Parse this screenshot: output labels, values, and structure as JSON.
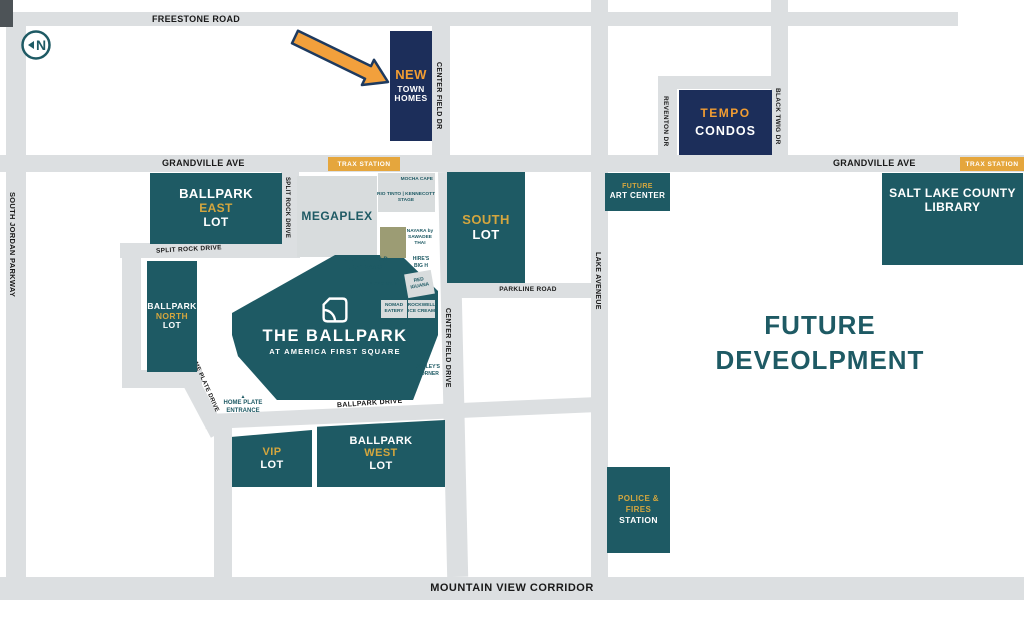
{
  "colors": {
    "teal": "#1e5a64",
    "navy": "#1c2e5a",
    "gold": "#d4a63e",
    "orange": "#f29d32",
    "badge_orange": "#e5a63d",
    "road_gray": "#dcdfe1",
    "building_gray": "#d8dcdd",
    "khaki": "#9c9c74"
  },
  "north_indicator": {
    "letter": "N"
  },
  "roads": {
    "freestone": "FREESTONE ROAD",
    "grandville_west": "GRANDVILLE AVE",
    "grandville_east": "GRANDVILLE AVE",
    "south_jordan": "SOUTH JORDAN PARKWAY",
    "center_field_dr_top": "CENTER FIELD DR",
    "center_field_drive": "CENTER FIELD DRIVE",
    "split_rock_vertical": "SPLIT ROCK DRIVE",
    "split_rock_horizontal": "SPLIT ROCK DRIVE",
    "home_plate_drive": "HOME PLATE DRIVE",
    "ballpark_drive": "BALLPARK DRIVE",
    "parkline": "PARKLINE ROAD",
    "lake_avenue": "LAKE AVENEUE",
    "reventon": "REVENTON DR",
    "black_twig": "BLACK TWIG DR",
    "mountain_view": "MOUNTAIN VIEW CORRIDOR"
  },
  "badges": {
    "trax_west": "TRAX  STATION",
    "trax_east": "TRAX  STATION"
  },
  "buildings": {
    "new_town_homes": {
      "line1": "NEW",
      "line2": "TOWN",
      "line3": "HOMES"
    },
    "tempo_condos": {
      "line1": "TEMPO",
      "line2": "CONDOS"
    },
    "megaplex": {
      "label": "MEGAPLEX"
    },
    "ballpark_east_lot": {
      "line1": "BALLPARK",
      "line2": "EAST",
      "line3": "LOT"
    },
    "ballpark_north_lot": {
      "line1": "BALLPARK",
      "line2": "NORTH",
      "line3": "LOT"
    },
    "south_lot": {
      "line1": "SOUTH",
      "line2": "LOT"
    },
    "vip_lot": {
      "line1": "VIP",
      "line2": "LOT"
    },
    "ballpark_west_lot": {
      "line1": "BALLPARK",
      "line2": "WEST",
      "line3": "LOT"
    },
    "the_ballpark": {
      "title": "THE BALLPARK",
      "subtitle": "AT AMERICA FIRST SQUARE"
    },
    "future_art_center": {
      "line1": "FUTURE",
      "line2": "ART CENTER"
    },
    "library": {
      "line1": "SALT LAKE COUNTY",
      "line2": "LIBRARY"
    },
    "police_fire_station": {
      "line1": "POLICE &",
      "line2": "FIRES",
      "line3": "STATION"
    },
    "future_development": {
      "line1": "FUTURE",
      "line2": "DEVEOLPMENT"
    }
  },
  "pois": {
    "mocha_cafe": "MOCHA CAFE",
    "rio_tinto_stage": {
      "line1": "RIO TINTO | KENNECOTT",
      "line2": "STAGE"
    },
    "nayara": {
      "line1": "NAYARA by",
      "line2": "SAWADEE",
      "line3": "THAI"
    },
    "hires_big_h": {
      "line1": "HIRE'S",
      "line2": "BIG H"
    },
    "playground": "PLAYGROUND",
    "red_iguana": {
      "line1": "RED",
      "line2": "IGUANA"
    },
    "nomad_eatery": {
      "line1": "NOMAD",
      "line2": "EATERY"
    },
    "rockwell": {
      "line1": "ROCKWELL",
      "line2": "ICE CREAM"
    },
    "jolleys_corner": {
      "line1": "JOLLEY'S",
      "line2": "CORNER"
    },
    "center_field_entrance": {
      "line1": "CENTER FIELD",
      "line2": "ENTRANCE"
    },
    "home_plate_entrance": {
      "line1": "HOME PLATE",
      "line2": "ENTRANCE"
    }
  }
}
